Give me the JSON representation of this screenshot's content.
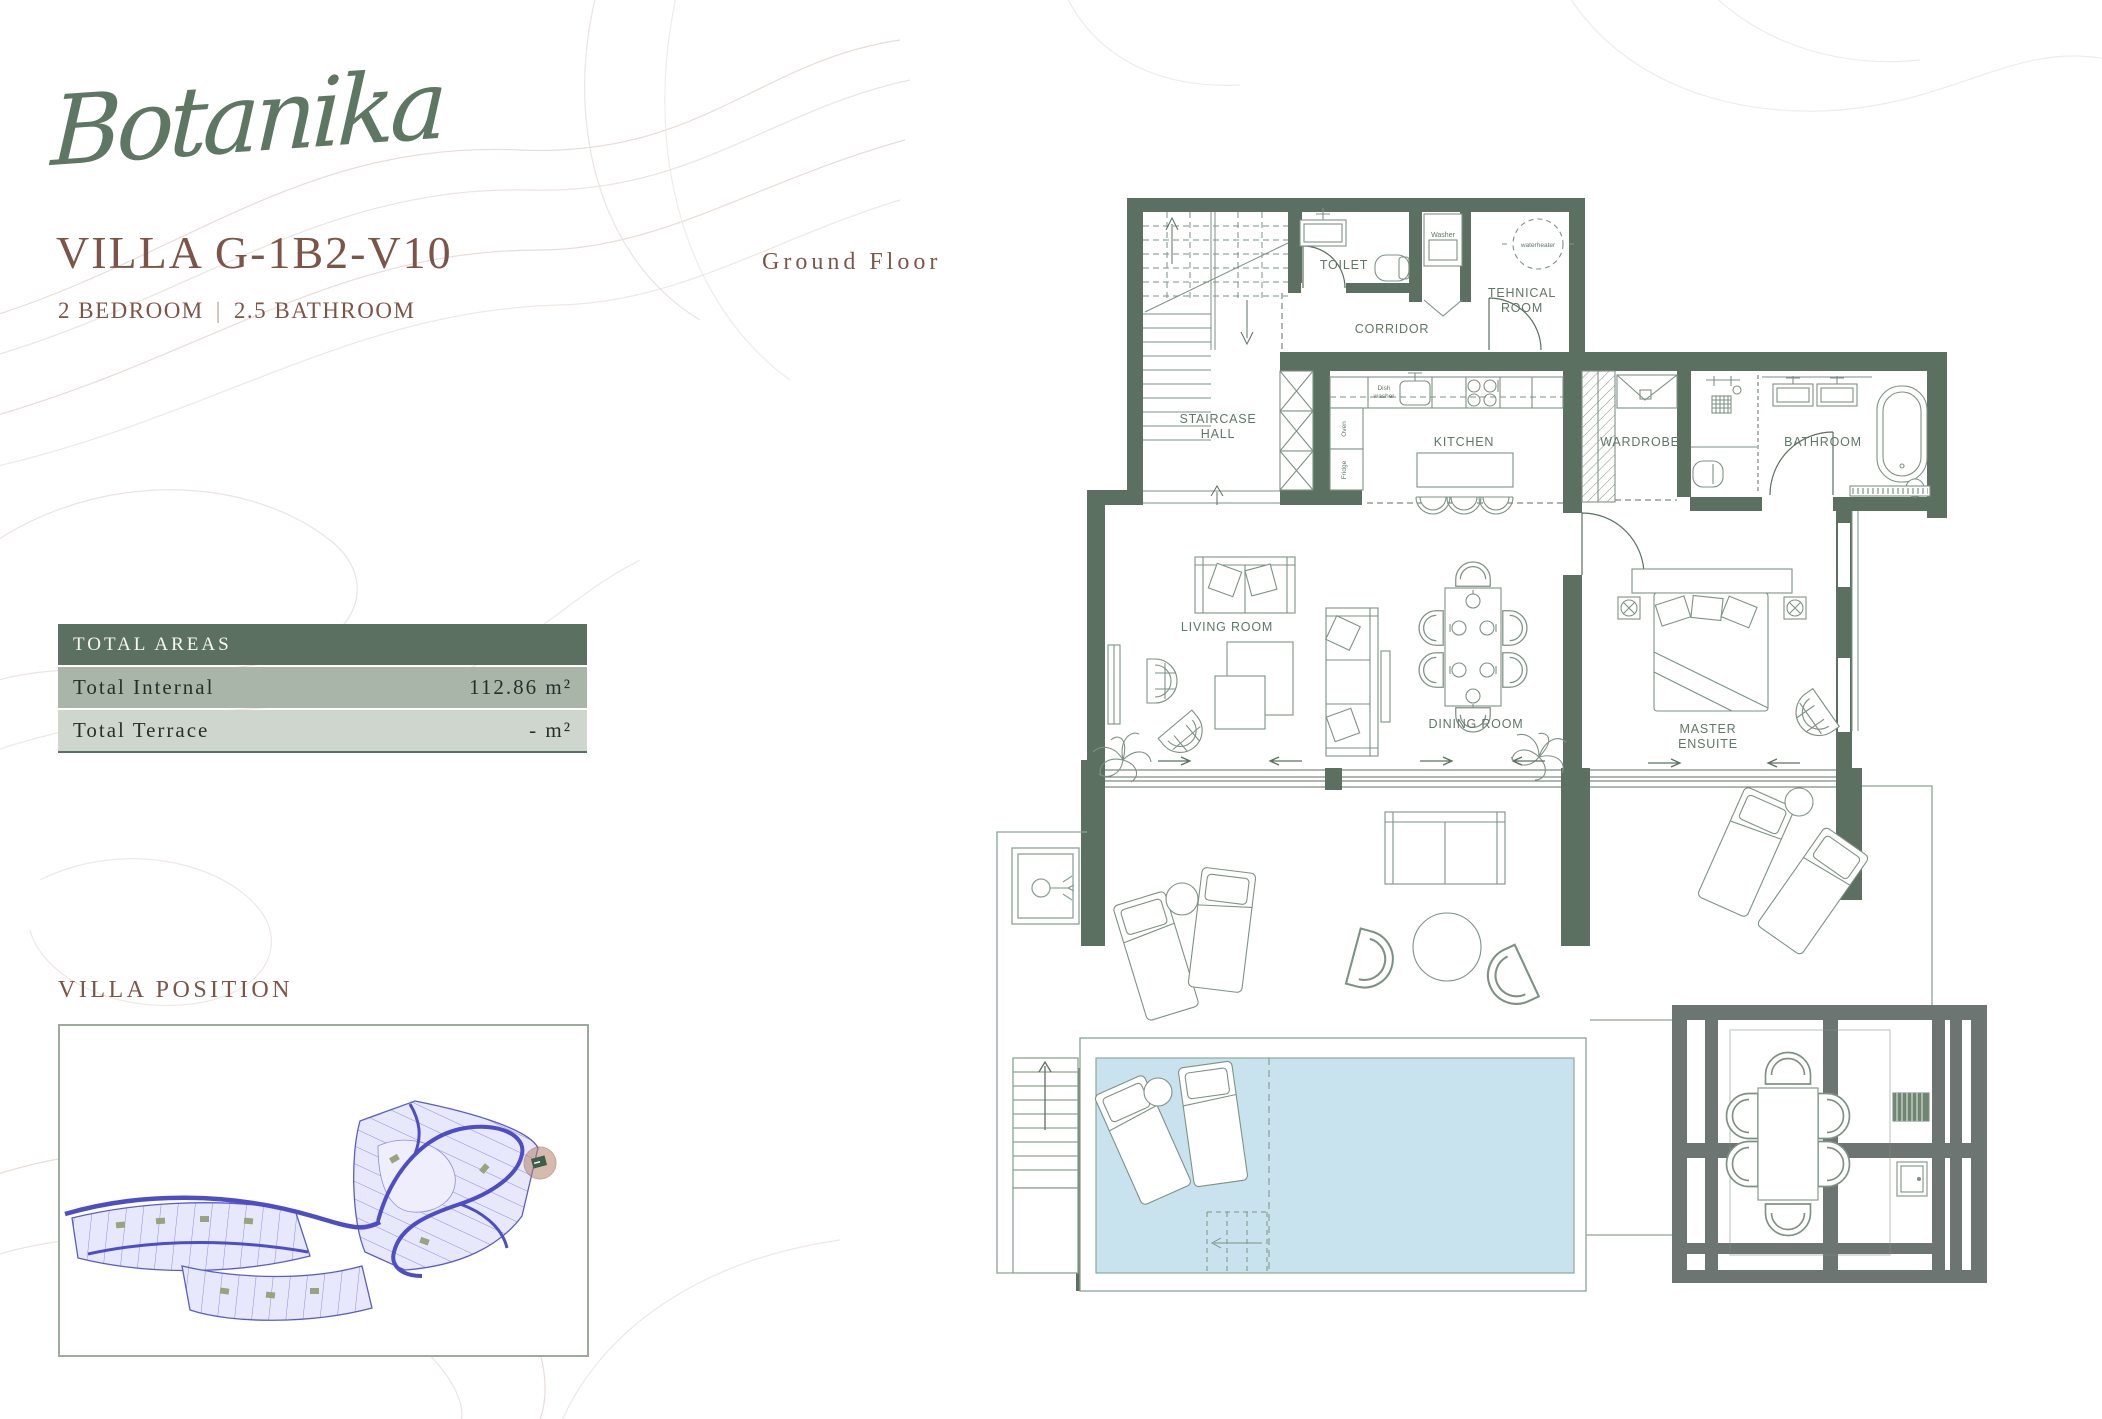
{
  "brand": {
    "logo_text": "Botanika"
  },
  "header": {
    "villa_title": "VILLA G-1B2-V10",
    "bedrooms": "2 BEDROOM",
    "separator": "|",
    "bathrooms": "2.5 BATHROOM",
    "floor_label": "Ground Floor"
  },
  "total_areas": {
    "header": "TOTAL AREAS",
    "rows": [
      {
        "label": "Total Internal",
        "value": "112.86 m²"
      },
      {
        "label": "Total Terrace",
        "value": "- m²"
      }
    ]
  },
  "villa_position": {
    "heading": "VILLA POSITION"
  },
  "floor_plan": {
    "rooms": {
      "staircase_hall_line1": "STAIRCASE",
      "staircase_hall_line2": "HALL",
      "toilet": "TOILET",
      "corridor": "CORRIDOR",
      "tehnical_line1": "TEHNICAL",
      "tehnical_line2": "ROOM",
      "kitchen": "KITCHEN",
      "wardrobe": "WARDROBE",
      "bathroom": "BATHROOM",
      "living_room": "LIVING ROOM",
      "dining_room": "DINING ROOM",
      "master_line1": "MASTER",
      "master_line2": "ENSUITE"
    },
    "fixtures": {
      "washer": "Washer",
      "waterheater": "waterheater",
      "dishwasher_line1": "Dish",
      "dishwasher_line2": "washer",
      "oven": "Oven",
      "fridge": "Fridge"
    }
  },
  "colors": {
    "wall_green": "#5c7061",
    "label_green": "#5f7768",
    "furniture_line": "#7e9284",
    "heading_brown": "#7d5547",
    "logo_green": "#5e7763",
    "pool_blue": "#c8e3ed",
    "pergola_grey": "#6d7572",
    "areas_header_bg": "#5c7061",
    "areas_row1_bg": "#a9b5a9",
    "areas_row2_bg": "#cfd6cd",
    "map_purple": "#5c5cc8",
    "map_lot_fill": "#e7e8fb",
    "position_marker": "#b5826d"
  }
}
